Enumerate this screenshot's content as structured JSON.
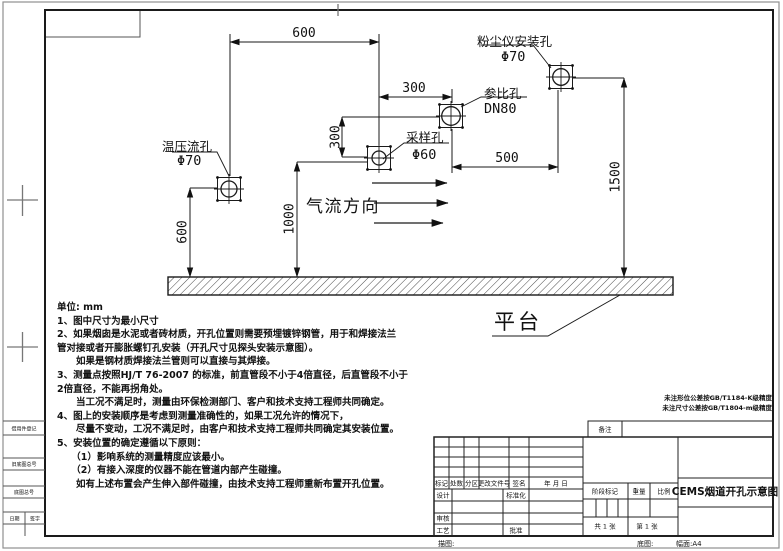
{
  "drawing": {
    "flow_label": "气流方向",
    "platform_label": "平台",
    "holes": [
      {
        "name": "温压流孔",
        "size": "Φ70"
      },
      {
        "name": "采样孔",
        "size": "Φ60"
      },
      {
        "name": "参比孔",
        "size": "DN80"
      },
      {
        "name": "粉尘仪安装孔",
        "size": "Φ70"
      }
    ],
    "dims": {
      "top600": "600",
      "h300": "300",
      "v300": "300",
      "h500": "500",
      "v1500": "1500",
      "v1000": "1000",
      "v600": "600"
    }
  },
  "notes": {
    "lines": [
      "单位: mm",
      "1、图中尺寸为最小尺寸",
      "2、如果烟囱是水泥或者砖材质，开孔位置则需要预埋镀锌钢管，用于和焊接法兰",
      "管对接或者开膨胀螺钉孔安装（开孔尺寸见探头安装示意图）。",
      "　　如果是钢材质焊接法兰管则可以直接与其焊接。",
      "3、测量点按照HJ/T 76-2007 的标准，前直管段不小于4倍直径，后直管段不小于",
      "2倍直径，不能再拐角处。",
      "　　当工况不满足时，测量由环保检测部门、客户和技术支持工程师共同确定。",
      "4、图上的安装顺序是考虑到测量准确性的，如果工况允许的情况下，",
      "　　尽量不变动，工况不满足时，由客户和技术支持工程师共同确定其安装位置。",
      "5、安装位置的确定遵循以下原则：",
      "　　（1）影响系统的测量精度应该最小。",
      "　　（2）有接入深度的仪器不能在管道内部产生碰撞。",
      "　　如有上述布置会产生伸入部件碰撞，由技术支持工程师重新布置开孔位置。"
    ]
  },
  "standards": {
    "line1": "未注形位公差按GB/T1184-K级精度",
    "line2": "未注尺寸公差按GB/T1804-m级精度"
  },
  "title_block": {
    "remark_label": "备注",
    "rev_headers": [
      "标记",
      "处数",
      "分区",
      "更改文件号",
      "签名",
      "年 月 日"
    ],
    "design_label": "设计",
    "standardization_label": "标准化",
    "review_label": "审核",
    "process_label": "工艺",
    "approve_label": "批准",
    "stage_label": "阶段标记",
    "weight_label": "重量",
    "scale_label": "比例",
    "sheet_total": "共 1 张",
    "sheet_no": "第 1 张",
    "title": "CEMS烟道开孔示意图",
    "trace_label": "描图:",
    "base_label": "底图:",
    "format_label": "幅面:A4"
  },
  "margin": {
    "labels": [
      "借用件登记",
      "旧底图总号",
      "底图总号"
    ],
    "date_label": "日期",
    "sign_label": "签字"
  }
}
